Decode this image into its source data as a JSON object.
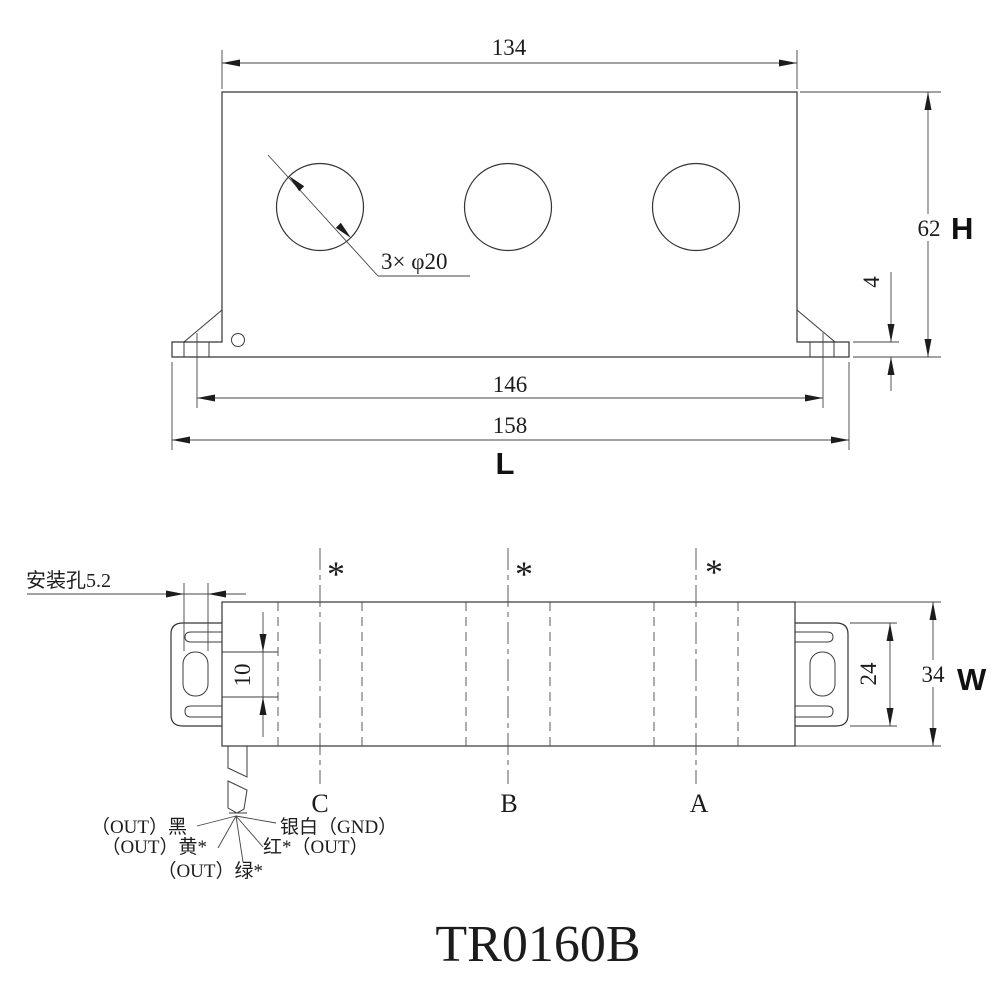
{
  "drawing": {
    "title": "TR0160B",
    "front_view": {
      "dim_top_width": "134",
      "holes_note": "3× φ20",
      "dim_height": "62",
      "height_symbol": "H",
      "dim_flange_thickness": "4",
      "dim_mount_span": "146",
      "dim_overall_length": "158",
      "length_symbol": "L"
    },
    "bottom_view": {
      "mount_hole_note": "安装孔5.2",
      "dim_lead_offset": "10",
      "dim_bracket_height": "24",
      "dim_body_width": "34",
      "width_symbol": "W",
      "phase_marks": [
        "*",
        "*",
        "*"
      ],
      "phase_labels": [
        "C",
        "B",
        "A"
      ],
      "wire_labels": {
        "black_out": "（OUT）黑",
        "yellow_out": "（OUT）黄*",
        "green_out": "（OUT）绿*",
        "red_out": "红*（OUT）",
        "silver_gnd": "银白（GND）"
      }
    },
    "colors": {
      "line": "#3c3c3c",
      "text": "#1c1c1c",
      "background": "#ffffff"
    }
  }
}
